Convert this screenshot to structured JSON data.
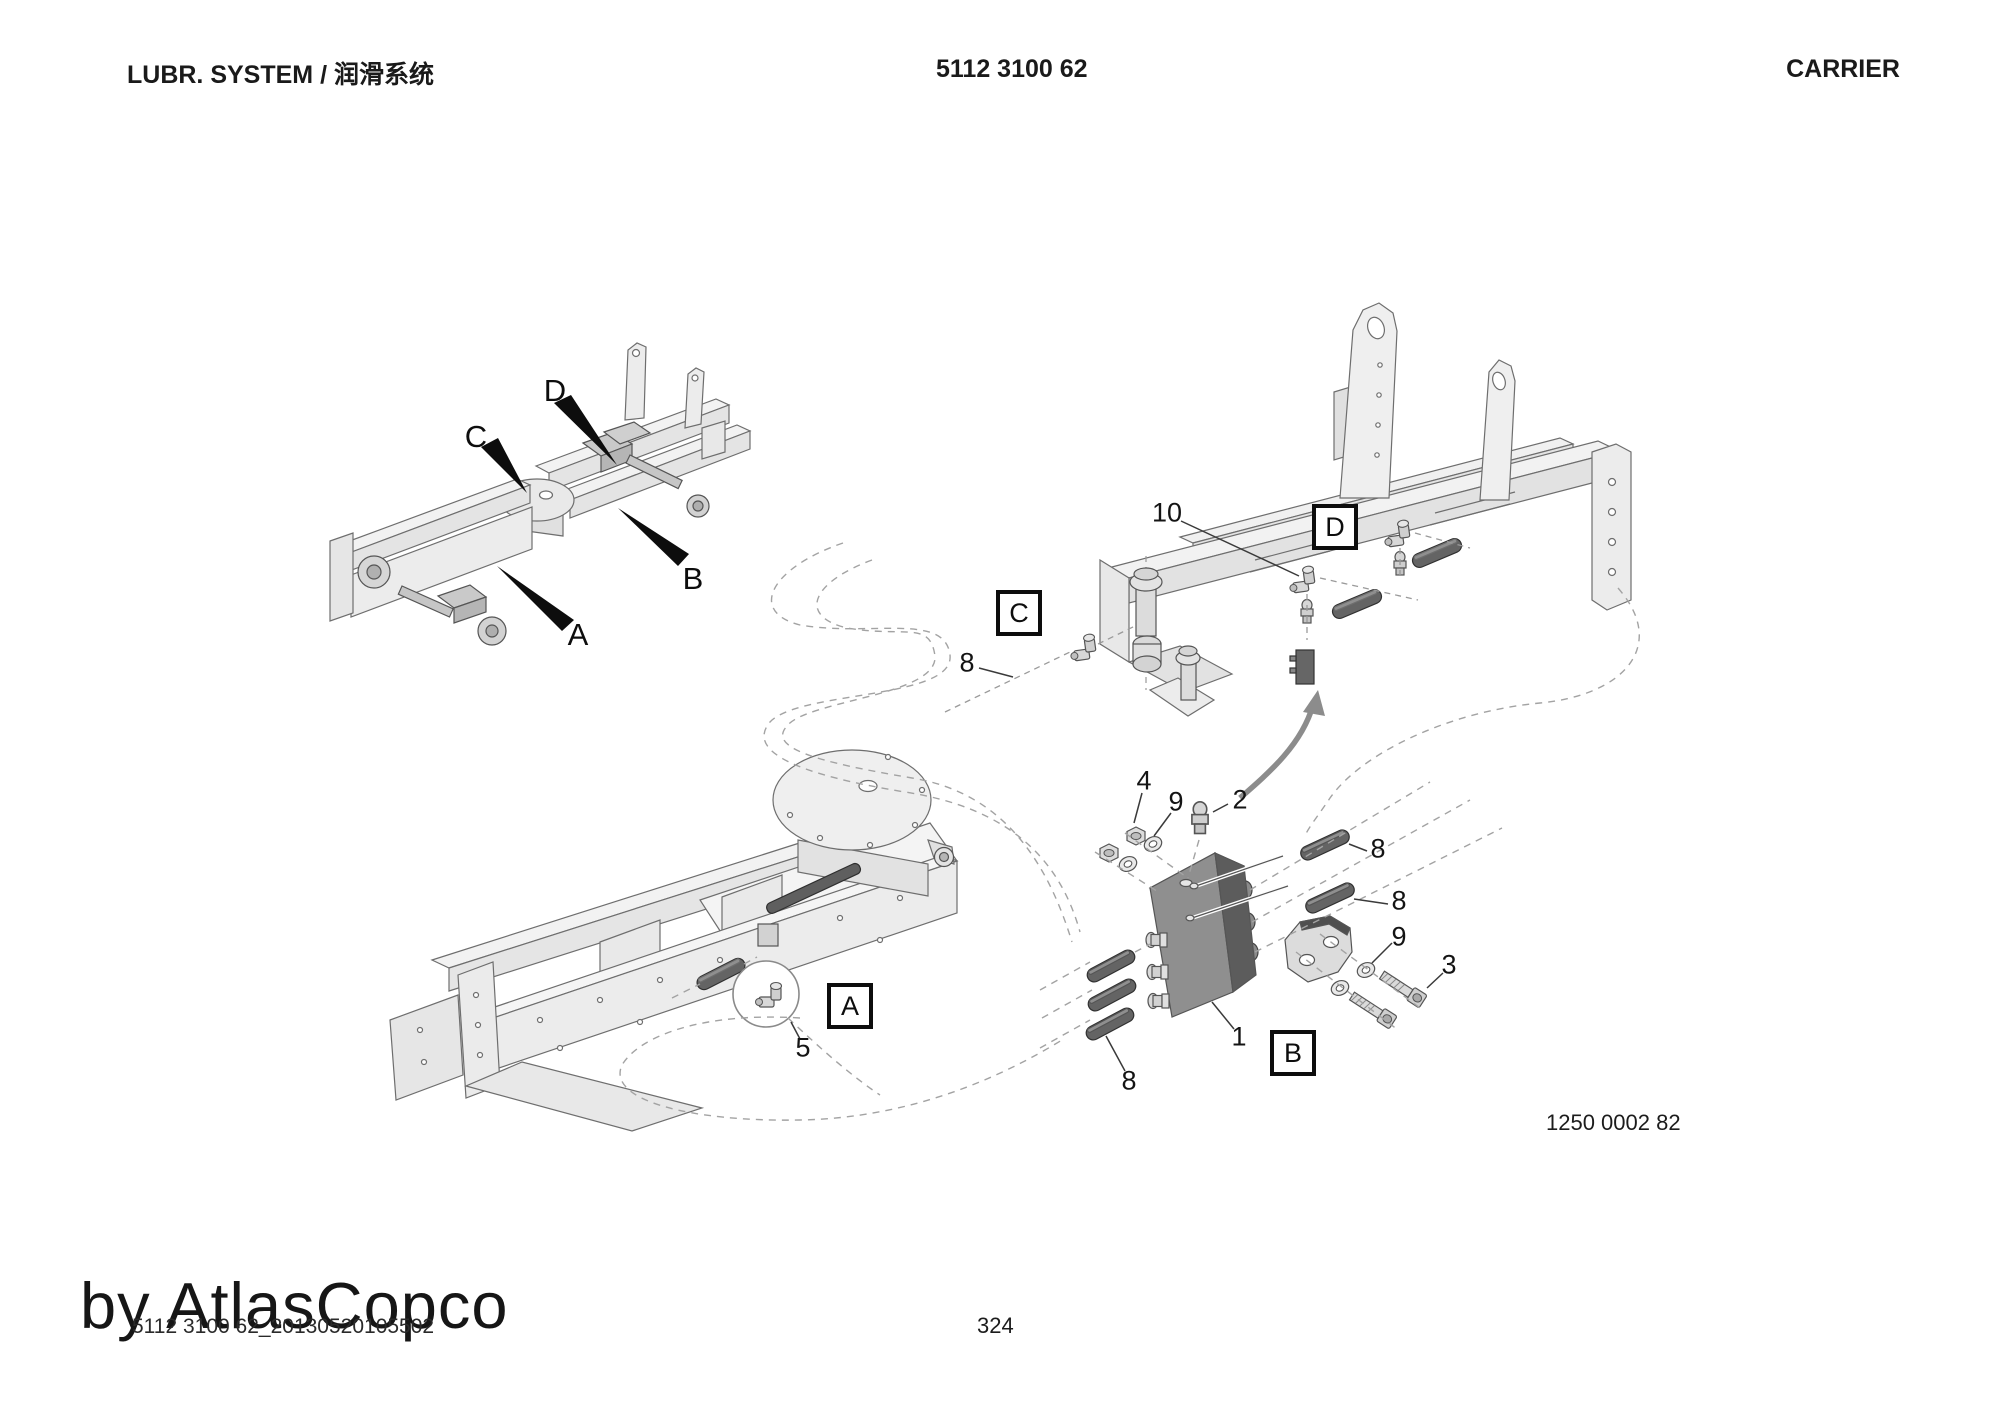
{
  "page": {
    "header": {
      "left": "LUBR. SYSTEM / 润滑系统",
      "center": "5112 3100 62",
      "right": "CARRIER"
    },
    "footer": {
      "page_number": "324",
      "ref_number": "1250 0002 82",
      "watermark": "by AtlasCopco",
      "file_id": "5112 3100 62_20130520105502"
    }
  },
  "callouts": {
    "view_labels": {
      "a": "A",
      "b": "B",
      "c": "C",
      "d": "D"
    },
    "detail_boxes": {
      "a": "A",
      "b": "B",
      "c": "C",
      "d": "D"
    },
    "items": {
      "n1": "1",
      "n2": "2",
      "n3": "3",
      "n4": "4",
      "n5": "5",
      "n8": "8",
      "n9": "9",
      "n10": "10"
    }
  },
  "colors": {
    "line_art_stroke": "#6e6e6e",
    "line_art_fill": "#ededed",
    "dark_part": "#5f5f5f",
    "text": "#111111"
  }
}
